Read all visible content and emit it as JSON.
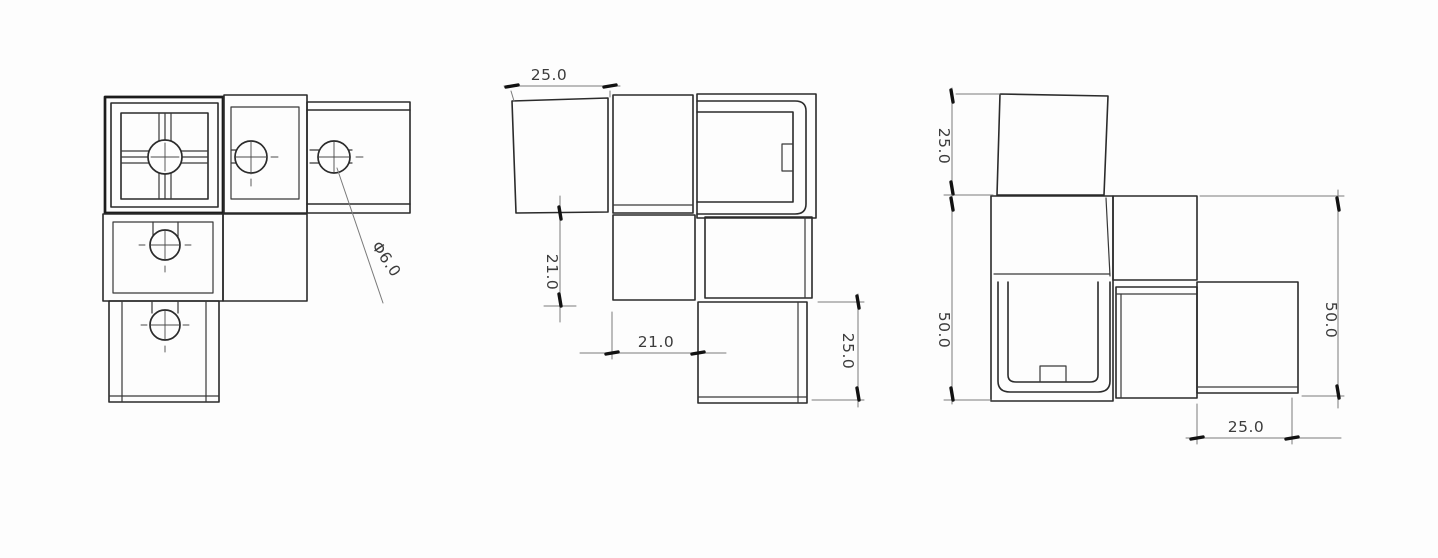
{
  "drawing": {
    "description": "three-view engineering drawing of a square-tube corner connector",
    "background": "#fdfdfd",
    "line_color": "#2b2b2b",
    "dim_color": "#7a7a7a",
    "views": {
      "front": {
        "hole_label": "Φ6.0"
      },
      "plan": {
        "dim_top_width": "25.0",
        "dim_left_height": "21.0",
        "dim_bottom_width": "21.0",
        "dim_right_height": "25.0"
      },
      "side": {
        "dim_top_height": "25.0",
        "dim_left_height": "50.0",
        "dim_right_height": "50.0",
        "dim_bottom_width": "25.0"
      }
    }
  }
}
